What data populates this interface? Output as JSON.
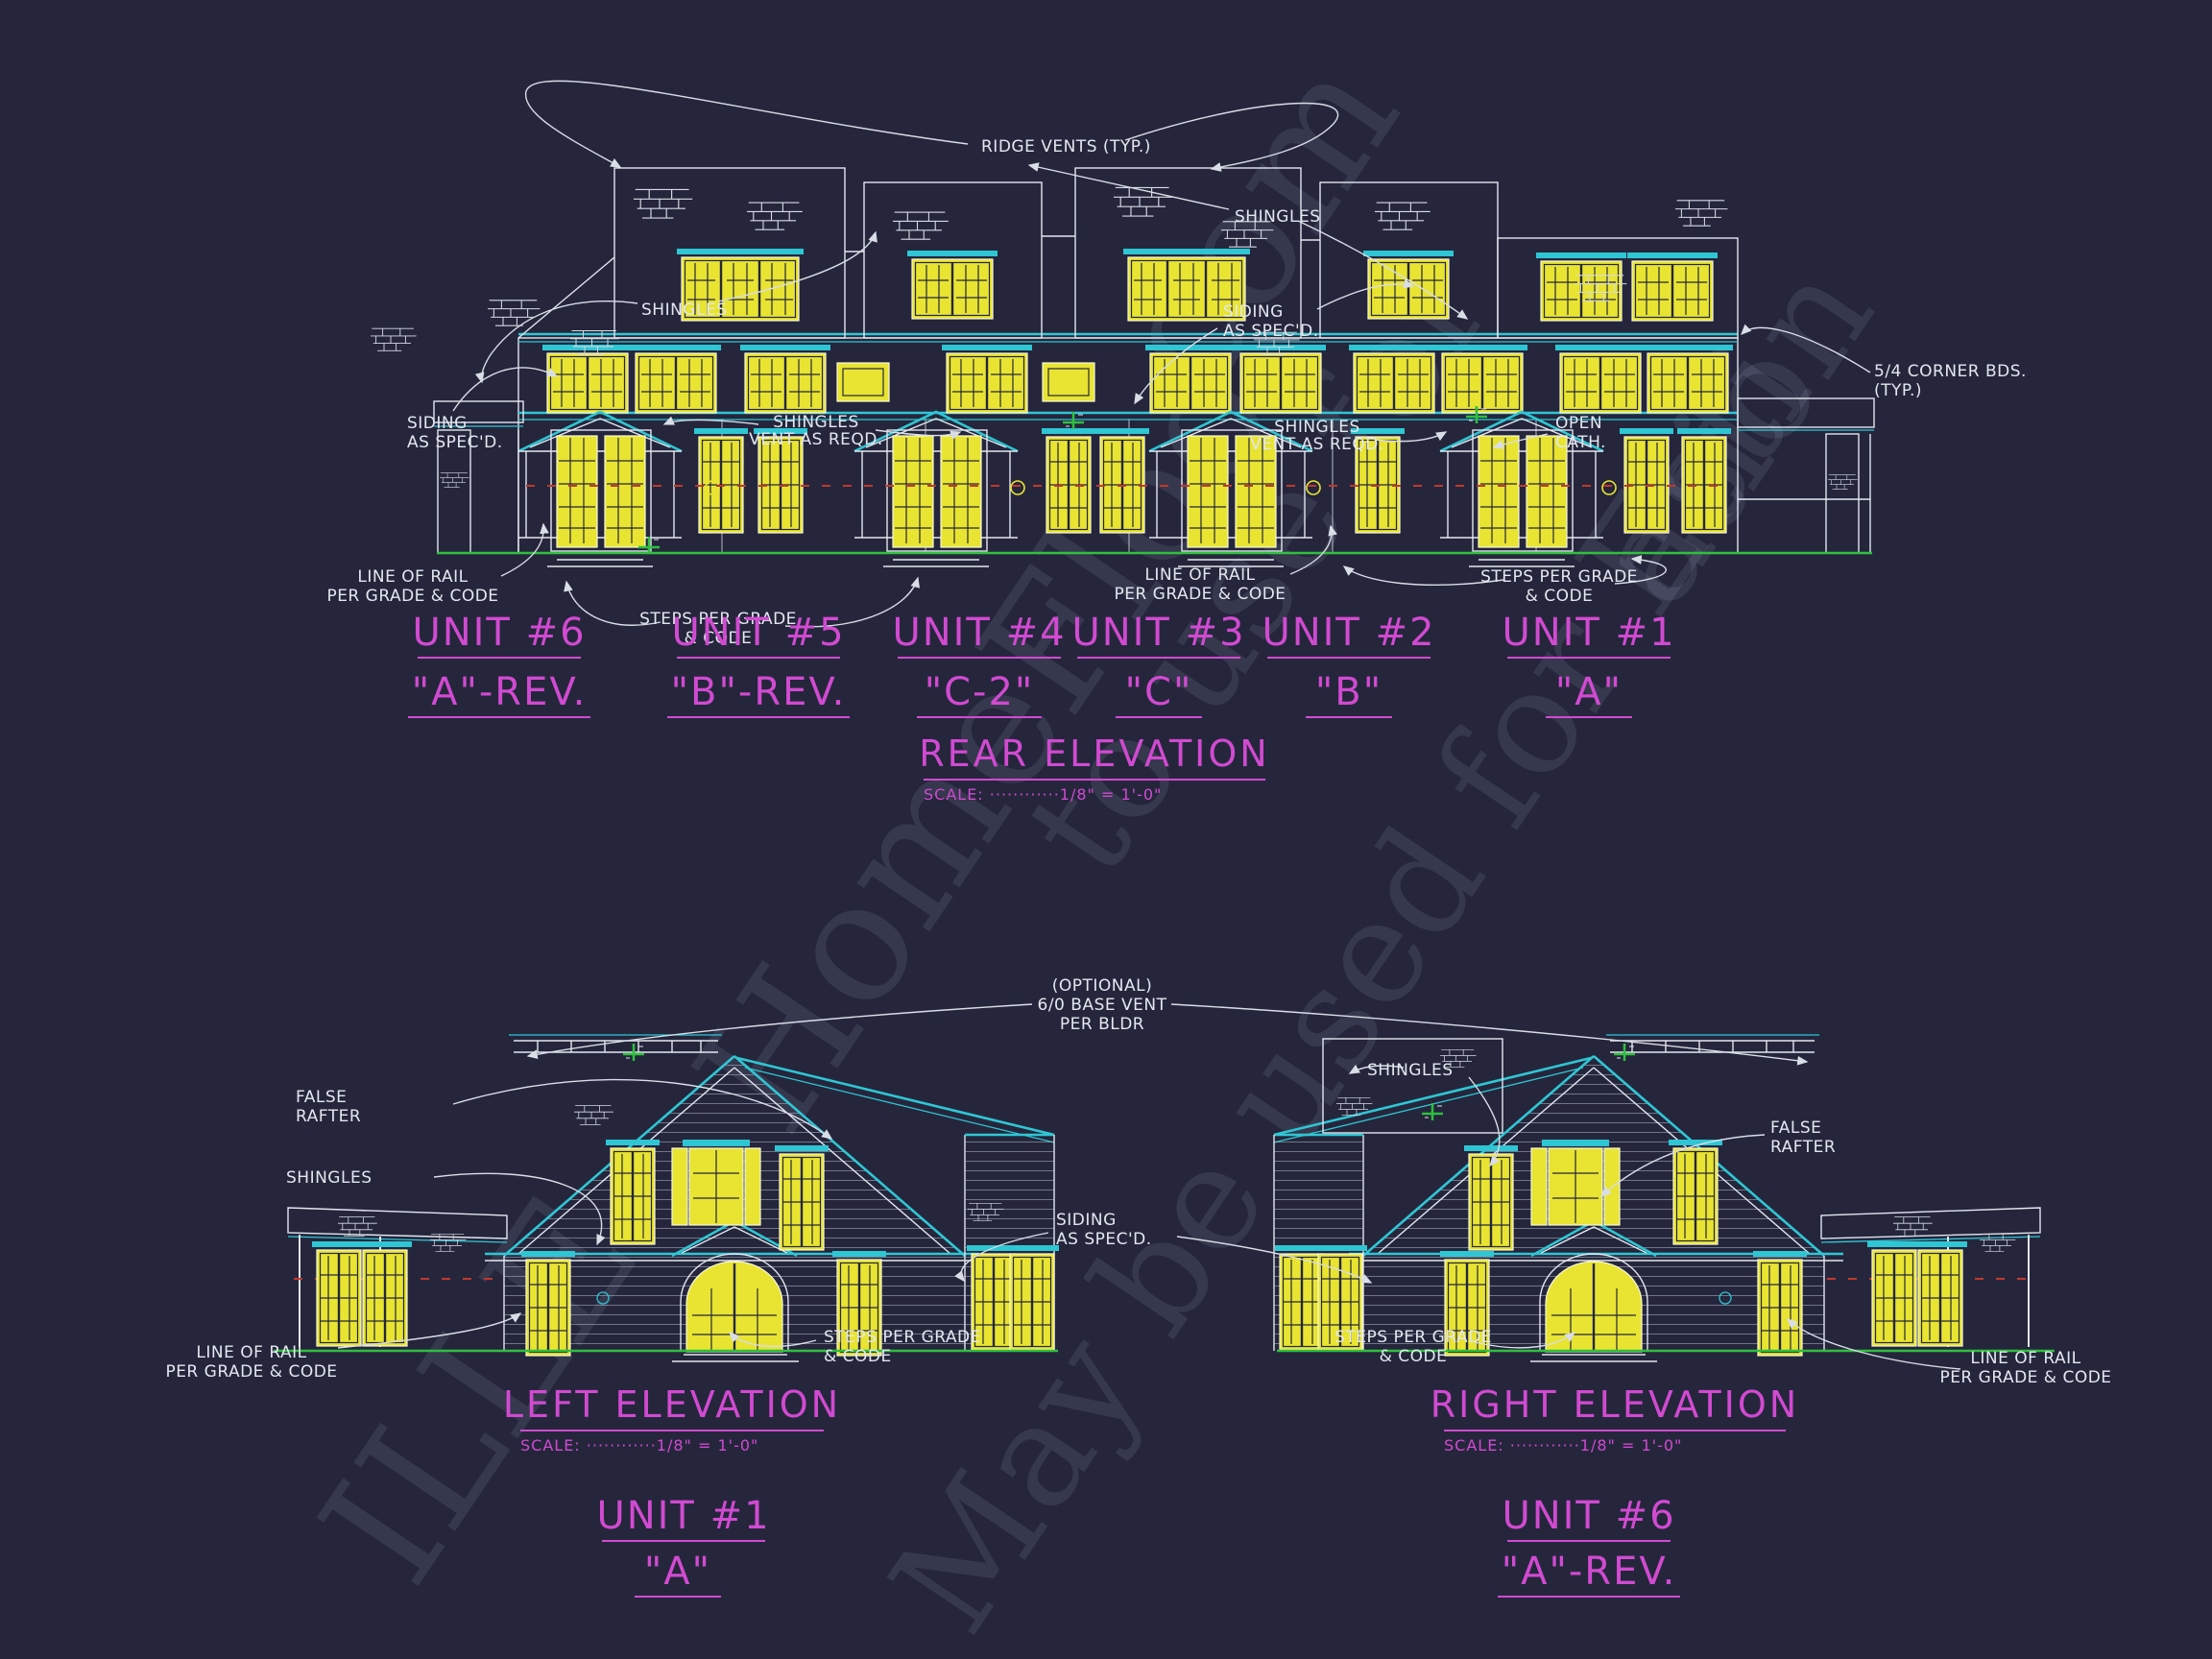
{
  "annotations": {
    "ridge_vents": "RIDGE VENTS (TYP.)",
    "shingles": "SHINGLES",
    "siding_line1": "SIDING",
    "siding_line2": "AS SPEC'D.",
    "vent_line1": "SHINGLES",
    "vent_line2": "VENT AS REQD.",
    "corner_line1": "5/4 CORNER BDS.",
    "corner_line2": "(TYP.)",
    "open_cath_line1": "OPEN",
    "open_cath_line2": "CATH.",
    "rail_line1": "LINE OF RAIL",
    "rail_line2": "PER GRADE & CODE",
    "steps_line1": "STEPS PER GRADE",
    "steps_line2": "& CODE",
    "false_rafter_line1": "FALSE",
    "false_rafter_line2": "RAFTER",
    "optional_vent_line1": "(OPTIONAL)",
    "optional_vent_line2": "6/0 BASE VENT",
    "optional_vent_line3": "PER BLDR"
  },
  "rear": {
    "title": "REAR ELEVATION",
    "scale": "SCALE: ············1/8\" = 1'-0\"",
    "units": [
      {
        "number": "UNIT #6",
        "variant": "\"A\"-REV."
      },
      {
        "number": "UNIT #5",
        "variant": "\"B\"-REV."
      },
      {
        "number": "UNIT #4",
        "variant": "\"C-2\""
      },
      {
        "number": "UNIT #3",
        "variant": "\"C\""
      },
      {
        "number": "UNIT #2",
        "variant": "\"B\""
      },
      {
        "number": "UNIT #1",
        "variant": "\"A\""
      }
    ]
  },
  "left": {
    "title": "LEFT ELEVATION",
    "scale": "SCALE: ············1/8\" = 1'-0\"",
    "unit_number": "UNIT #1",
    "unit_variant": "\"A\""
  },
  "right": {
    "title": "RIGHT ELEVATION",
    "scale": "SCALE: ············1/8\" = 1'-0\"",
    "unit_number": "UNIT #6",
    "unit_variant": "\"A\"-REV."
  },
  "watermark": {
    "fragments": [
      "HomeFloo",
      "com",
      "ILLE",
      "May be used for Esti",
      "to use for",
      "ation"
    ]
  },
  "colors": {
    "background": "#25263c",
    "line_cyan": "#2fc6d4",
    "line_white": "#e3e7ef",
    "window_yellow": "#e8e431",
    "text_magenta": "#d14ad1",
    "ground_green": "#2fbf3f",
    "rail_red": "#c0392b"
  }
}
